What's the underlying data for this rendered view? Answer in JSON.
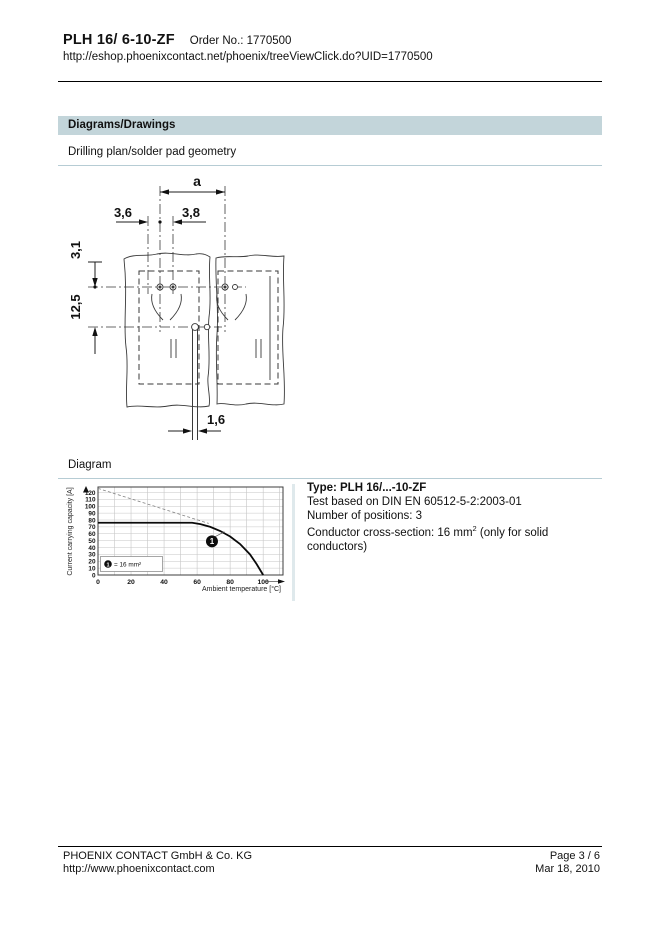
{
  "header": {
    "title": "PLH 16/ 6-10-ZF",
    "order_no": "Order No.: 1770500",
    "url": "http://eshop.phoenixcontact.net/phoenix/treeViewClick.do?UID=1770500"
  },
  "section": {
    "title": "Diagrams/Drawings"
  },
  "drilling": {
    "heading": "Drilling plan/solder pad geometry",
    "dims": {
      "a": "a",
      "h36": "3,6",
      "h38": "3,8",
      "v31": "3,1",
      "v125": "12,5",
      "slot16": "1,6"
    }
  },
  "diagram": {
    "heading": "Diagram"
  },
  "info": {
    "type": "Type: PLH 16/...-10-ZF",
    "test": "Test based on DIN EN 60512-5-2:2003-01",
    "positions": "Number of positions: 3",
    "conductor_pre": "Conductor cross-section: 16 mm",
    "conductor_sup": "2",
    "conductor_post": " (only for solid conductors)"
  },
  "chart_data": {
    "type": "line",
    "title": "",
    "xlabel": "Ambient temperature [°C]",
    "ylabel": "Current carrying capacity [A]",
    "xlim": [
      0,
      112
    ],
    "ylim": [
      0,
      128
    ],
    "x_ticks": [
      0,
      20,
      40,
      60,
      80,
      100
    ],
    "y_ticks": [
      0,
      10,
      20,
      30,
      40,
      50,
      60,
      70,
      80,
      90,
      100,
      110,
      120
    ],
    "grid_step_x": 10,
    "grid_step_y": 10,
    "grid": true,
    "legend_position": "lower-left",
    "series": [
      {
        "name": "16 mm2 conductor derating curve",
        "style": "solid",
        "x": [
          0,
          57,
          62,
          68,
          74,
          80,
          86,
          92,
          96,
          100
        ],
        "y": [
          76,
          76,
          74,
          70,
          64,
          56,
          45,
          30,
          16,
          0
        ]
      },
      {
        "name": "maximum current limit",
        "style": "dashed",
        "x": [
          0,
          67
        ],
        "y": [
          126,
          75
        ]
      }
    ],
    "marker": {
      "label": "1",
      "x": 69,
      "y": 49,
      "leader_x": 76.5,
      "leader_y": 63
    },
    "legend": {
      "marker": "1",
      "text": "= 16 mm²"
    }
  },
  "footer": {
    "company": "PHOENIX CONTACT GmbH & Co. KG",
    "website": "http://www.phoenixcontact.com",
    "page": "Page 3 / 6",
    "date": "Mar 18, 2010"
  },
  "colors": {
    "section_header_bg": "#c3d5da",
    "subheading_rule": "#b6ccd4",
    "curve": "#0a0a0a",
    "grid": "#c6c6c6"
  }
}
